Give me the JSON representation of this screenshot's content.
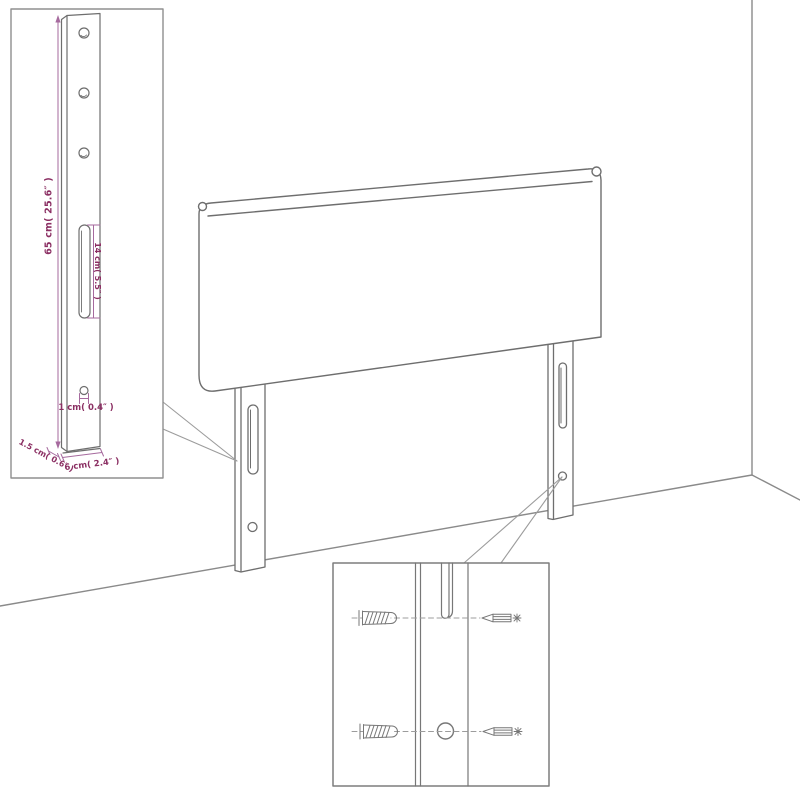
{
  "colors": {
    "background": "#ffffff",
    "drawing_line": "#6e6e6e",
    "inset_border": "#8f8f8f",
    "callout_line": "#9c9c9c",
    "dimension_line": "#a66a9e",
    "dimension_text": "#8b2f63"
  },
  "dimension_inset": {
    "height_label": "65 cm( 25.6″ )",
    "slot_label": "14 cm( 5.5″ )",
    "hole_label": "1 cm( 0.4″ )",
    "thickness_label": "1.5 cm( 0.6″ )",
    "width_label": "6 cm( 2.4″ )"
  }
}
